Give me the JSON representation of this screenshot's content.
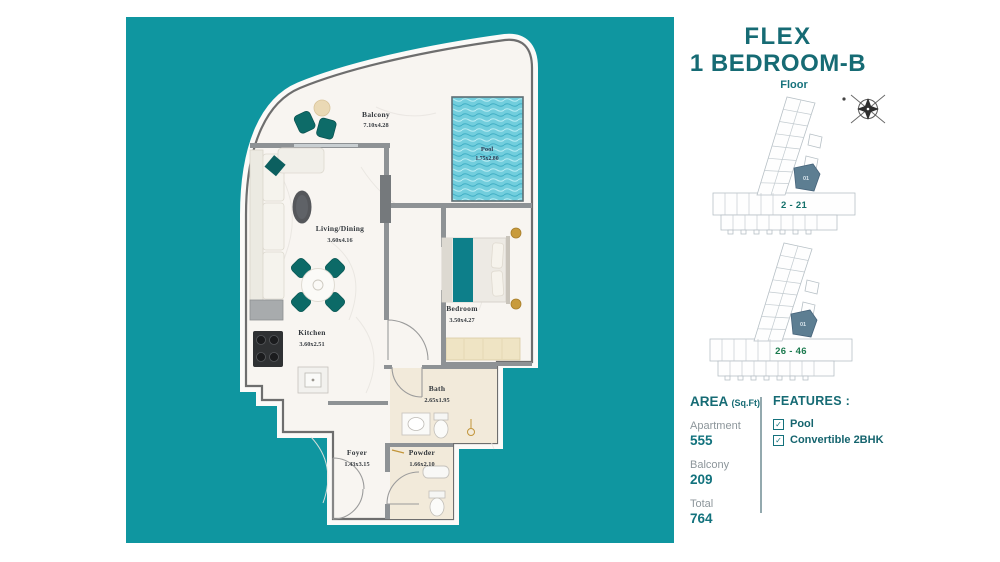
{
  "title": {
    "line1": "FLEX",
    "line2": "1 BEDROOM-B",
    "floor_label": "Floor"
  },
  "plan": {
    "rooms": [
      {
        "name": "Balcony",
        "dims": "7.10x4.28"
      },
      {
        "name": "Pool",
        "dims": "1.75x2.80"
      },
      {
        "name": "Living/Dining",
        "dims": "3.60x4.16"
      },
      {
        "name": "Kitchen",
        "dims": "3.60x2.51"
      },
      {
        "name": "Bedroom",
        "dims": "3.50x4.27"
      },
      {
        "name": "Bath",
        "dims": "2.65x1.95"
      },
      {
        "name": "Powder",
        "dims": "1.66x2.10"
      },
      {
        "name": "Foyer",
        "dims": "1.43x3.15"
      }
    ]
  },
  "diagrams": [
    {
      "range": "2 - 21",
      "unit": "01"
    },
    {
      "range": "26 - 46",
      "unit": "01"
    }
  ],
  "area": {
    "heading": "AREA",
    "heading_unit": "(Sq.Ft)",
    "items": [
      {
        "label": "Apartment",
        "value": "555"
      },
      {
        "label": "Balcony",
        "value": "209"
      },
      {
        "label": "Total",
        "value": "764"
      }
    ]
  },
  "features": {
    "heading": "FEATURES :",
    "check_glyph": "✓",
    "items": [
      {
        "label": "Pool"
      },
      {
        "label": "Convertible 2BHK"
      }
    ]
  },
  "colors": {
    "teal_background": "#0F96A0",
    "dark_teal_text": "#166B74",
    "value_teal": "#12727D",
    "label_gray": "#8D969B",
    "range1": "#14716B",
    "range2": "#1B7A4E",
    "highlight_unit": "#5D7E92",
    "pool_water": "#72CEDD",
    "furniture_teal": "#0D6B68",
    "gold_accent": "#C2953B"
  }
}
